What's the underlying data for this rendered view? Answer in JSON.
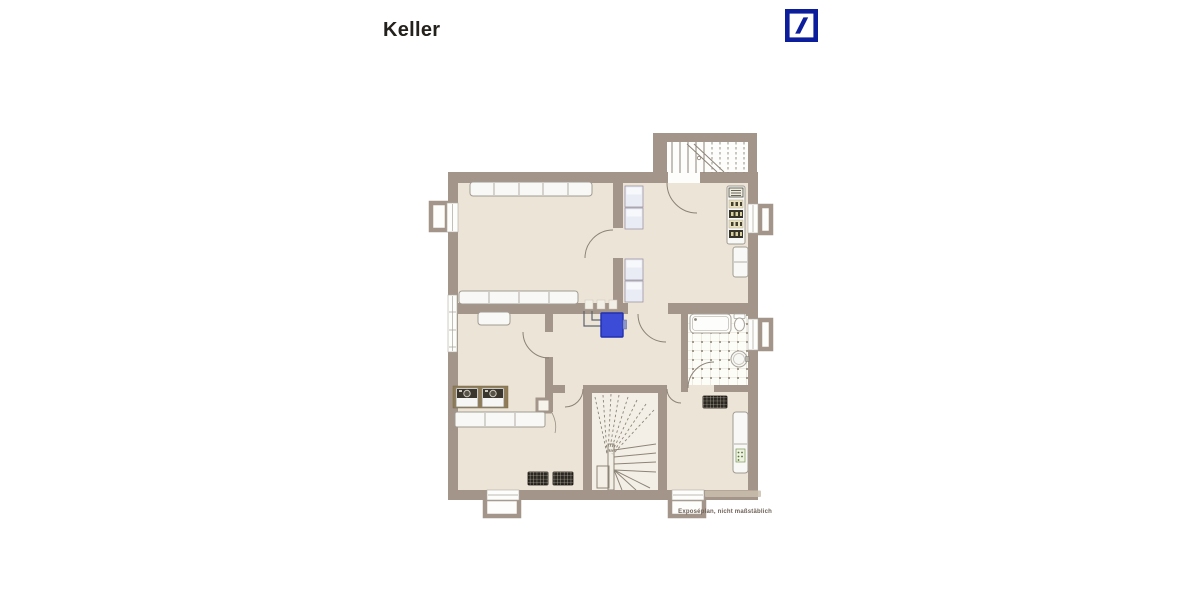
{
  "page": {
    "title": "Keller",
    "caption": "Exposéplan, nicht maßstäblich"
  },
  "icons": {
    "logo": "deutsche-bank-logo"
  },
  "colors": {
    "bg": "#ffffff",
    "title": "#24211d",
    "caption": "#6e6156",
    "wall": "#a39589",
    "wall-light": "#cabfae",
    "floor": "#ece4d6",
    "floor-white": "#fdfdfb",
    "line": "#8d8478",
    "furn-fill": "#f8f8f6",
    "furn-stroke": "#a19b91",
    "cabinet-fill": "#e9ebf5",
    "counter-brown": "#8f7c57",
    "rack-cream": "#e9e1bd",
    "rack-dark": "#38342a",
    "radiator": "#2b2721",
    "radiator-line": "#d8d2c6",
    "boiler": "#3c4cd7",
    "boiler-stroke": "#202fb0",
    "tile-line": "#d5cfc2",
    "tile-dot": "#877d6e",
    "db-blue": "#0c1e9b"
  }
}
